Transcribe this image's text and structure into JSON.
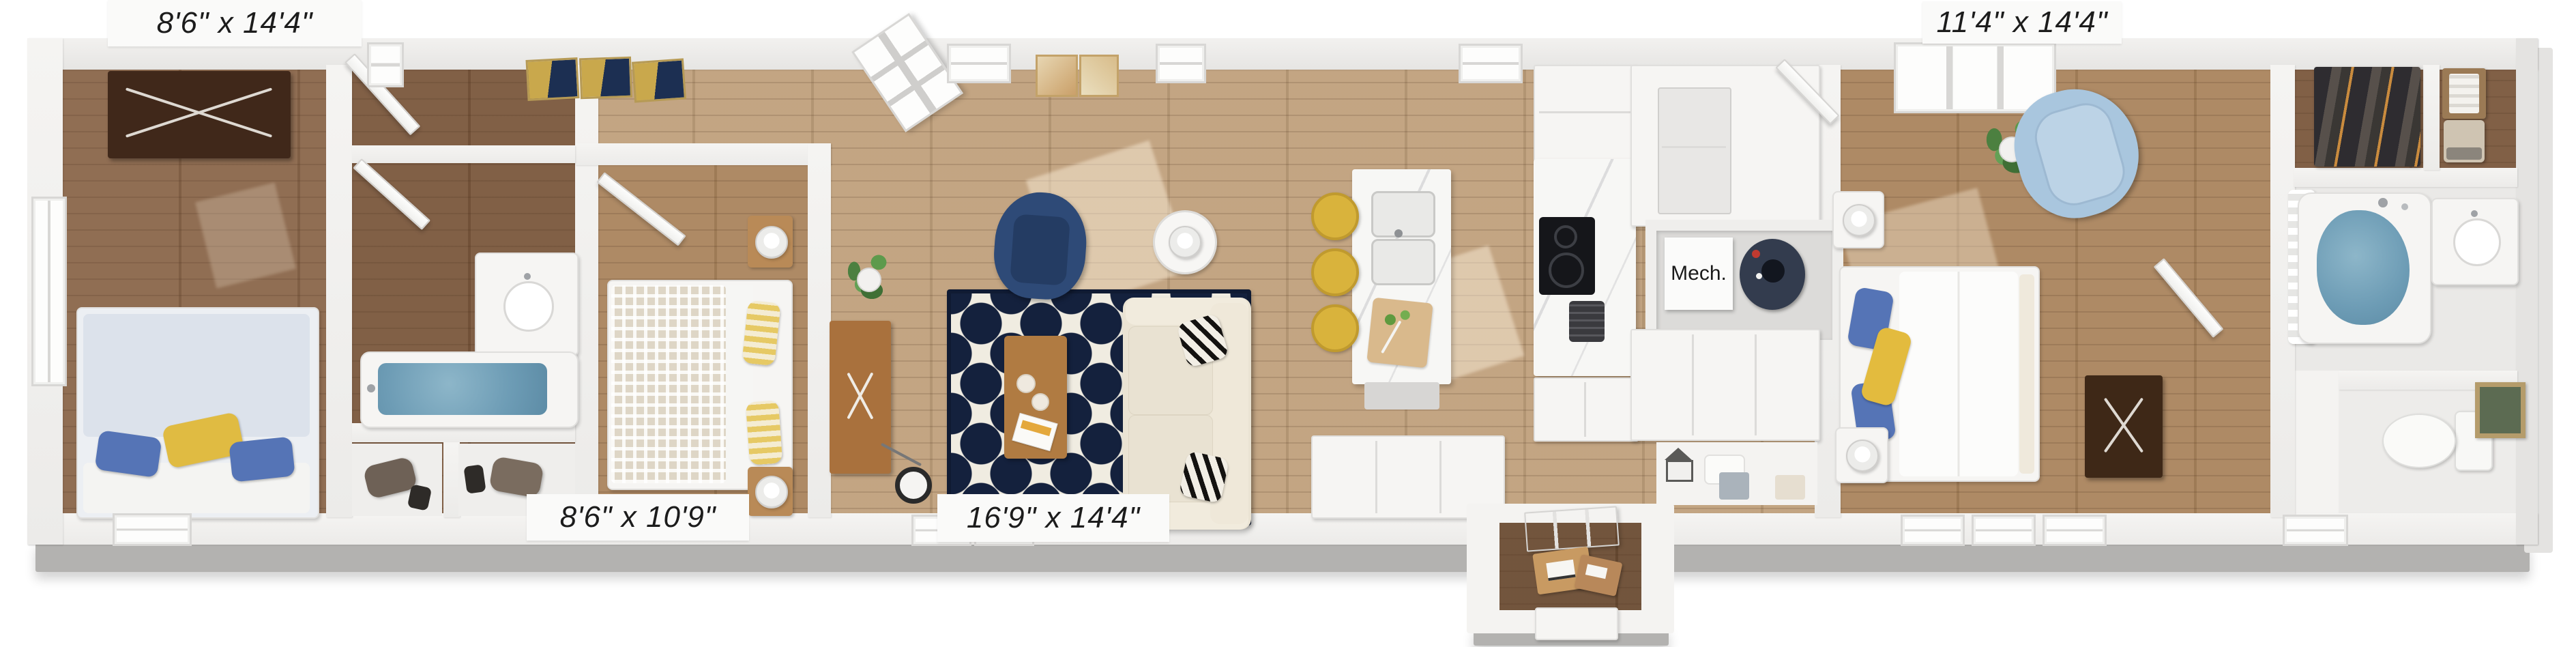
{
  "page": {
    "title": "3D floor plan rendering of a single-wide home"
  },
  "labels": {
    "bedroom_left_dim": "8'6\" x 14'4\"",
    "bedroom_middle_dim": "8'6\" x 10'9\"",
    "living_room_dim": "16'9\" x 14'4\"",
    "bedroom_right_dim": "11'4\" x 14'4\"",
    "mech_room": "Mech."
  },
  "colors": {
    "wall_white": "#f4f3f1",
    "wall_shadow_gray": "#b3b2b0",
    "floor_wood_light": "#c0a07c",
    "floor_wood_medium": "#aa845d",
    "floor_wood_dark": "#8a664a",
    "rug_navy": "#14213d",
    "armchair_navy": "#2e4a77",
    "sofa_cream": "#eae3d3",
    "accent_yellow": "#e0bb42",
    "pillow_blue": "#5574b6",
    "lounge_chair_blue": "#a9c6de",
    "bath_water_blue": "#6d9cb5",
    "console_wood": "#a9713d",
    "dresser_dark_brown": "#40281a"
  }
}
